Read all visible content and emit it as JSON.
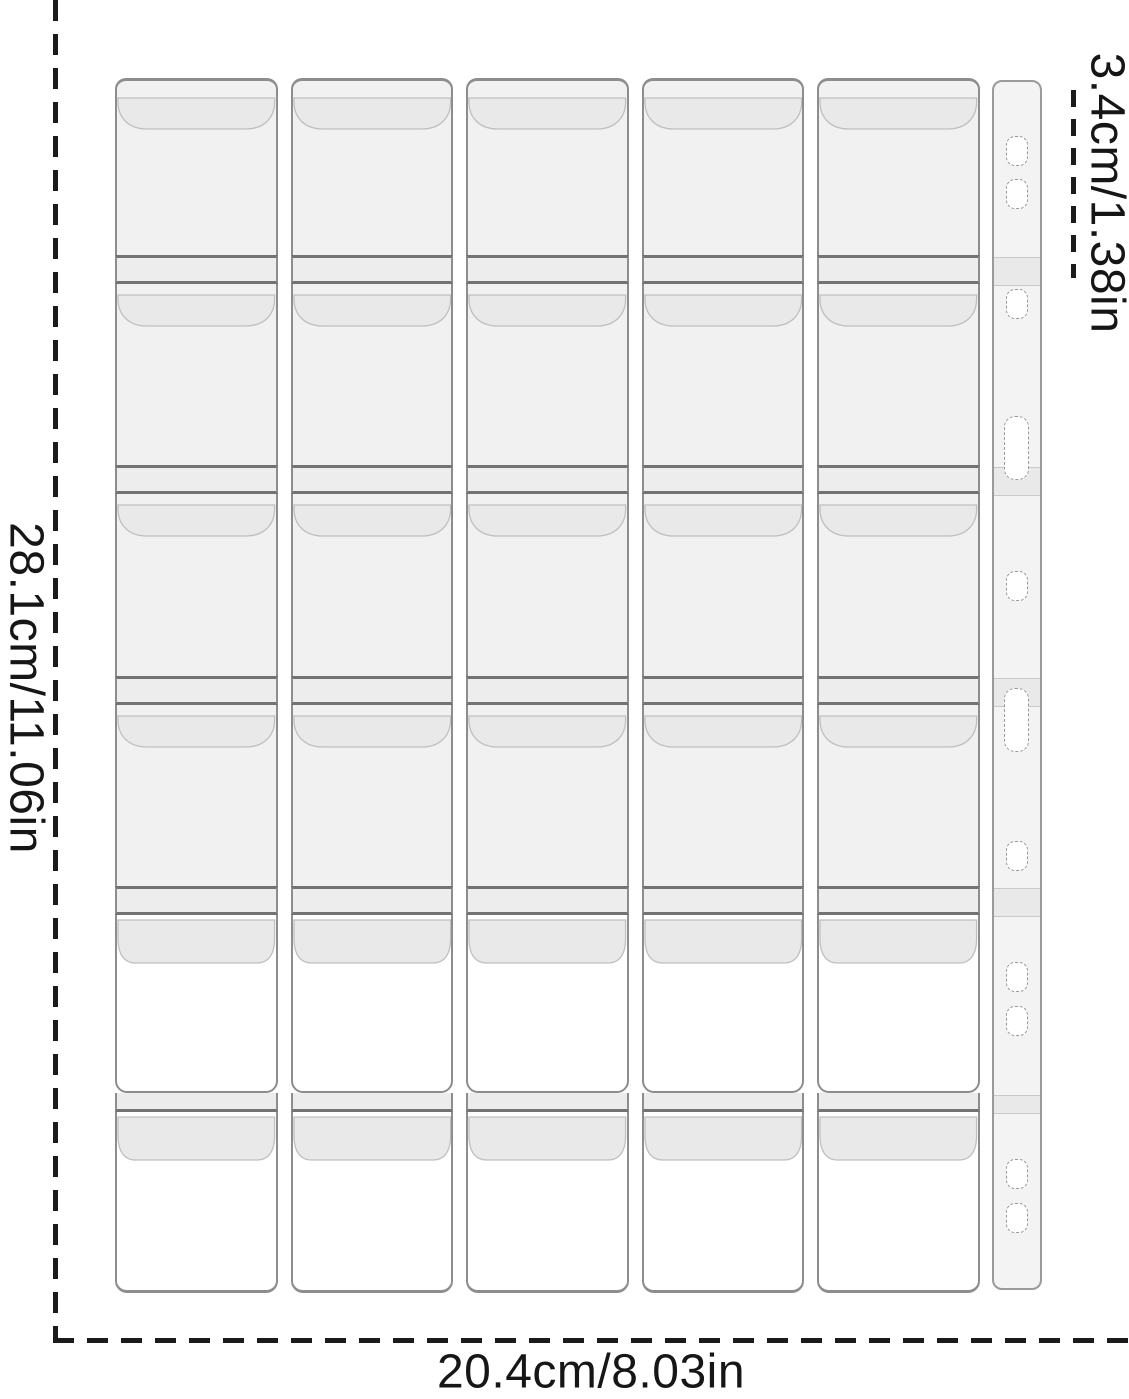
{
  "dimensions": {
    "height_label": "28.1cm/11.06in",
    "width_label": "20.4cm/8.03in",
    "pocket_label": "3.4cm/1.38in"
  },
  "grid": {
    "columns": 5,
    "rows": 6,
    "pocket_count": 30
  },
  "binding_strip": {
    "hole_count": 11,
    "holes": [
      {
        "y": 149,
        "type": "small"
      },
      {
        "y": 192,
        "type": "small"
      },
      {
        "y": 302,
        "type": "small"
      },
      {
        "y": 446,
        "type": "large"
      },
      {
        "y": 584,
        "type": "small"
      },
      {
        "y": 718,
        "type": "large"
      },
      {
        "y": 854,
        "type": "small"
      },
      {
        "y": 975,
        "type": "small"
      },
      {
        "y": 1019,
        "type": "small"
      },
      {
        "y": 1172,
        "type": "small"
      },
      {
        "y": 1216,
        "type": "small"
      }
    ],
    "seam_bands_y": [
      255,
      465,
      676,
      886,
      1093
    ]
  },
  "colors": {
    "page_background": "#ffffff",
    "pocket_fill": "#f1f1f1",
    "pocket_white_fill": "#ffffff",
    "flap_fill": "#e9e9e9",
    "flap_stroke": "#bfbfbf",
    "outline": "#8d8d8d",
    "separator_line": "#737373",
    "measure_line": "#1b1b1b"
  }
}
